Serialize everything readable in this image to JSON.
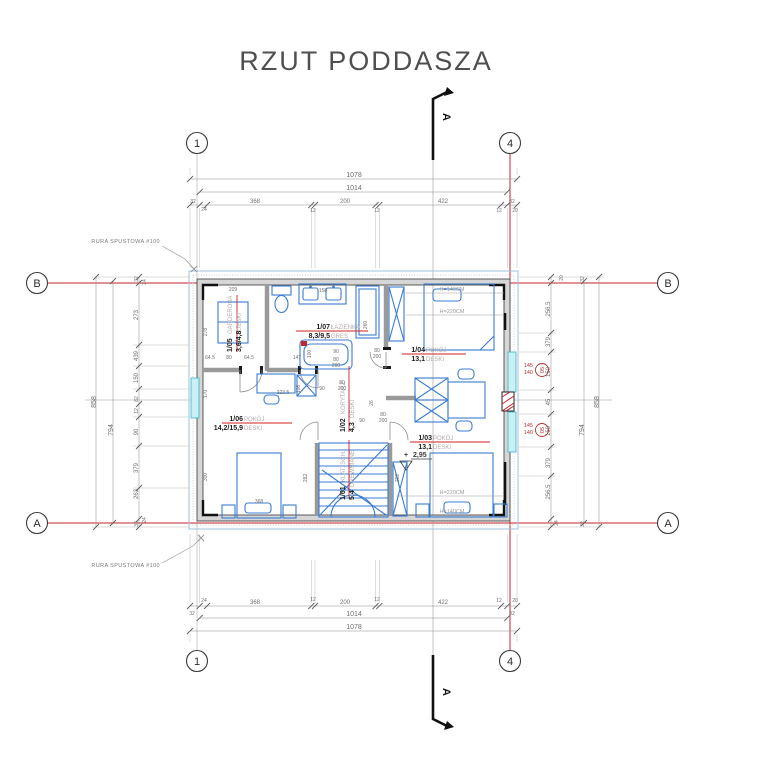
{
  "title": "RZUT PODDASZA",
  "grid": {
    "c1": "1",
    "c4": "4",
    "rA": "A",
    "rB": "B"
  },
  "section": {
    "label": "A"
  },
  "annotations": {
    "rura": "RURA SPUSTOWA #100",
    "level_sign": "+",
    "level_value": "2,95"
  },
  "beds": {
    "h140": "H=140CM",
    "h220": "H=220CM"
  },
  "win": {
    "code": "05",
    "w": "145",
    "s": "140"
  },
  "rooms": [
    {
      "id": "1/05",
      "name": "GARDEROBA",
      "area": "3,6/4,8",
      "floor": "DESKI"
    },
    {
      "id": "1/07",
      "name": "ŁAZIENKA",
      "area": "8,3/9,5",
      "floor": "GRES"
    },
    {
      "id": "1/04",
      "name": "POKÓJ",
      "area": "13,1",
      "floor": "DESKI"
    },
    {
      "id": "1/02",
      "name": "KORYTARZ",
      "area": "4,3",
      "floor": "DESKI"
    },
    {
      "id": "1/01",
      "name": "KLAT. SCH.",
      "area": "5,4",
      "floor": "DREWNIANE"
    },
    {
      "id": "1/06",
      "name": "POKÓJ",
      "area": "14,2/15,9",
      "floor": "DESKI"
    },
    {
      "id": "1/03",
      "name": "POKÓJ",
      "area": "13,1",
      "floor": "DESKI"
    }
  ],
  "dims": {
    "top": [
      "1078",
      "1014",
      "32",
      "24",
      "368",
      "12",
      "200",
      "12",
      "422",
      "12",
      "20",
      "32"
    ],
    "bottom": [
      "32",
      "24",
      "368",
      "12",
      "200",
      "12",
      "422",
      "12",
      "20",
      "32",
      "1014",
      "1078"
    ],
    "left": [
      "858",
      "794",
      "32",
      "24",
      "273",
      "439",
      "150",
      "82",
      "12",
      "90",
      "379",
      "263",
      "32",
      "24"
    ],
    "right": [
      "858",
      "794",
      "32",
      "256.5",
      "379",
      "150",
      "45",
      "150",
      "379",
      "256.5",
      "32",
      "20",
      "24"
    ],
    "interior": [
      "209",
      "278",
      "64.5",
      "80",
      "64.5",
      "147",
      "100",
      "90",
      "80",
      "200",
      "158",
      "260",
      "223.5",
      "108",
      "368",
      "300",
      "170",
      "282",
      "282",
      "90",
      "80",
      "200",
      "26",
      "90",
      "80",
      "200",
      "80",
      "200"
    ]
  },
  "colors": {
    "grid_red": "#c1272d",
    "furniture_blue": "#3a7cd0",
    "window_cyan": "#c9f0f5",
    "label_red": "#cc2222"
  }
}
